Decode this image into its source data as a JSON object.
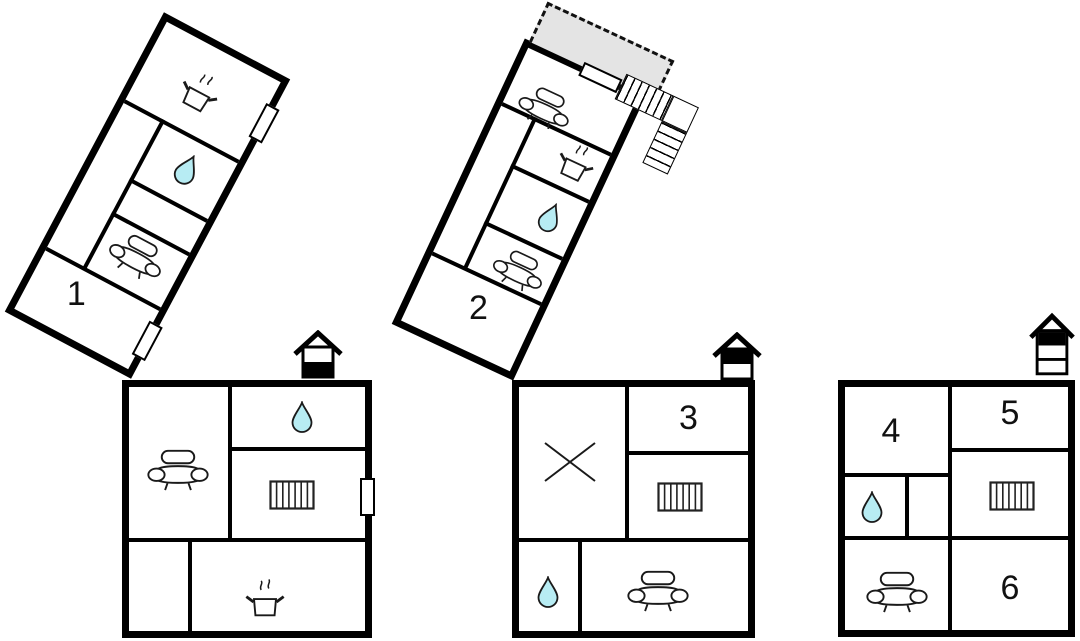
{
  "page": {
    "type": "floor-plan",
    "background": "#ffffff"
  },
  "colors": {
    "wall": "#000000",
    "line": "#1a1a1a",
    "water_drop": "#b7ecf3",
    "terrace_fill": "#e4e4e4"
  },
  "units": {
    "u1": "1",
    "u2": "2",
    "u3": "3",
    "u4": "4",
    "u5": "5",
    "u6": "6"
  },
  "icons": {
    "stove": "cooking-pot-with-steam",
    "water": "water-drop",
    "sofa": "sofa",
    "radiator": "radiator",
    "cross": "diagonal-cross",
    "stairs": "exterior-staircase",
    "terrace": "dashed-terrace",
    "floor_level_a": "house-ground-floor-indicator",
    "floor_level_b": "house-upper-floor-indicator",
    "floor_level_c": "house-top-floor-indicator"
  }
}
